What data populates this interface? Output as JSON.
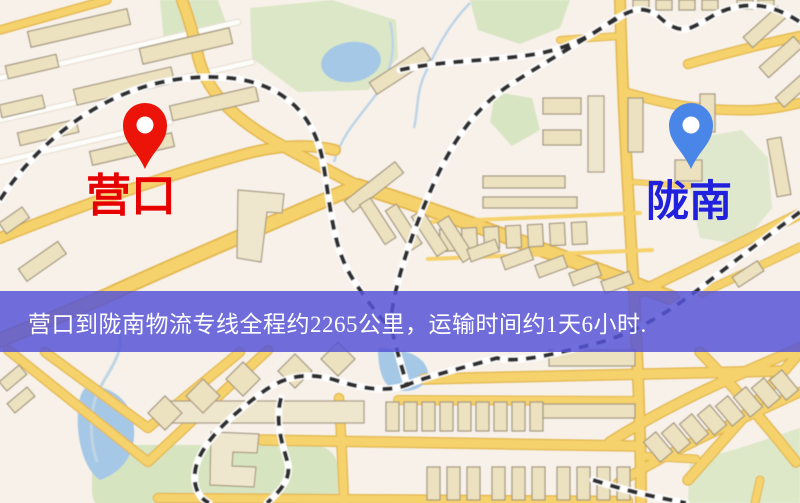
{
  "map": {
    "origin_marker": {
      "name": "营口",
      "pin_color": "#ec1408",
      "label_color": "#e60000"
    },
    "destination_marker": {
      "name": "陇南",
      "pin_color": "#4a86e8",
      "label_color": "#2121dd"
    }
  },
  "banner": {
    "text": "营口到陇南物流专线全程约2265公里，运输时间约1天6小时.",
    "background_color": "#5654d6",
    "text_color": "#ffffff"
  },
  "route_summary": {
    "origin": "营口",
    "destination": "陇南",
    "distance_text": "约2265公里",
    "duration_text": "约1天6小时"
  }
}
